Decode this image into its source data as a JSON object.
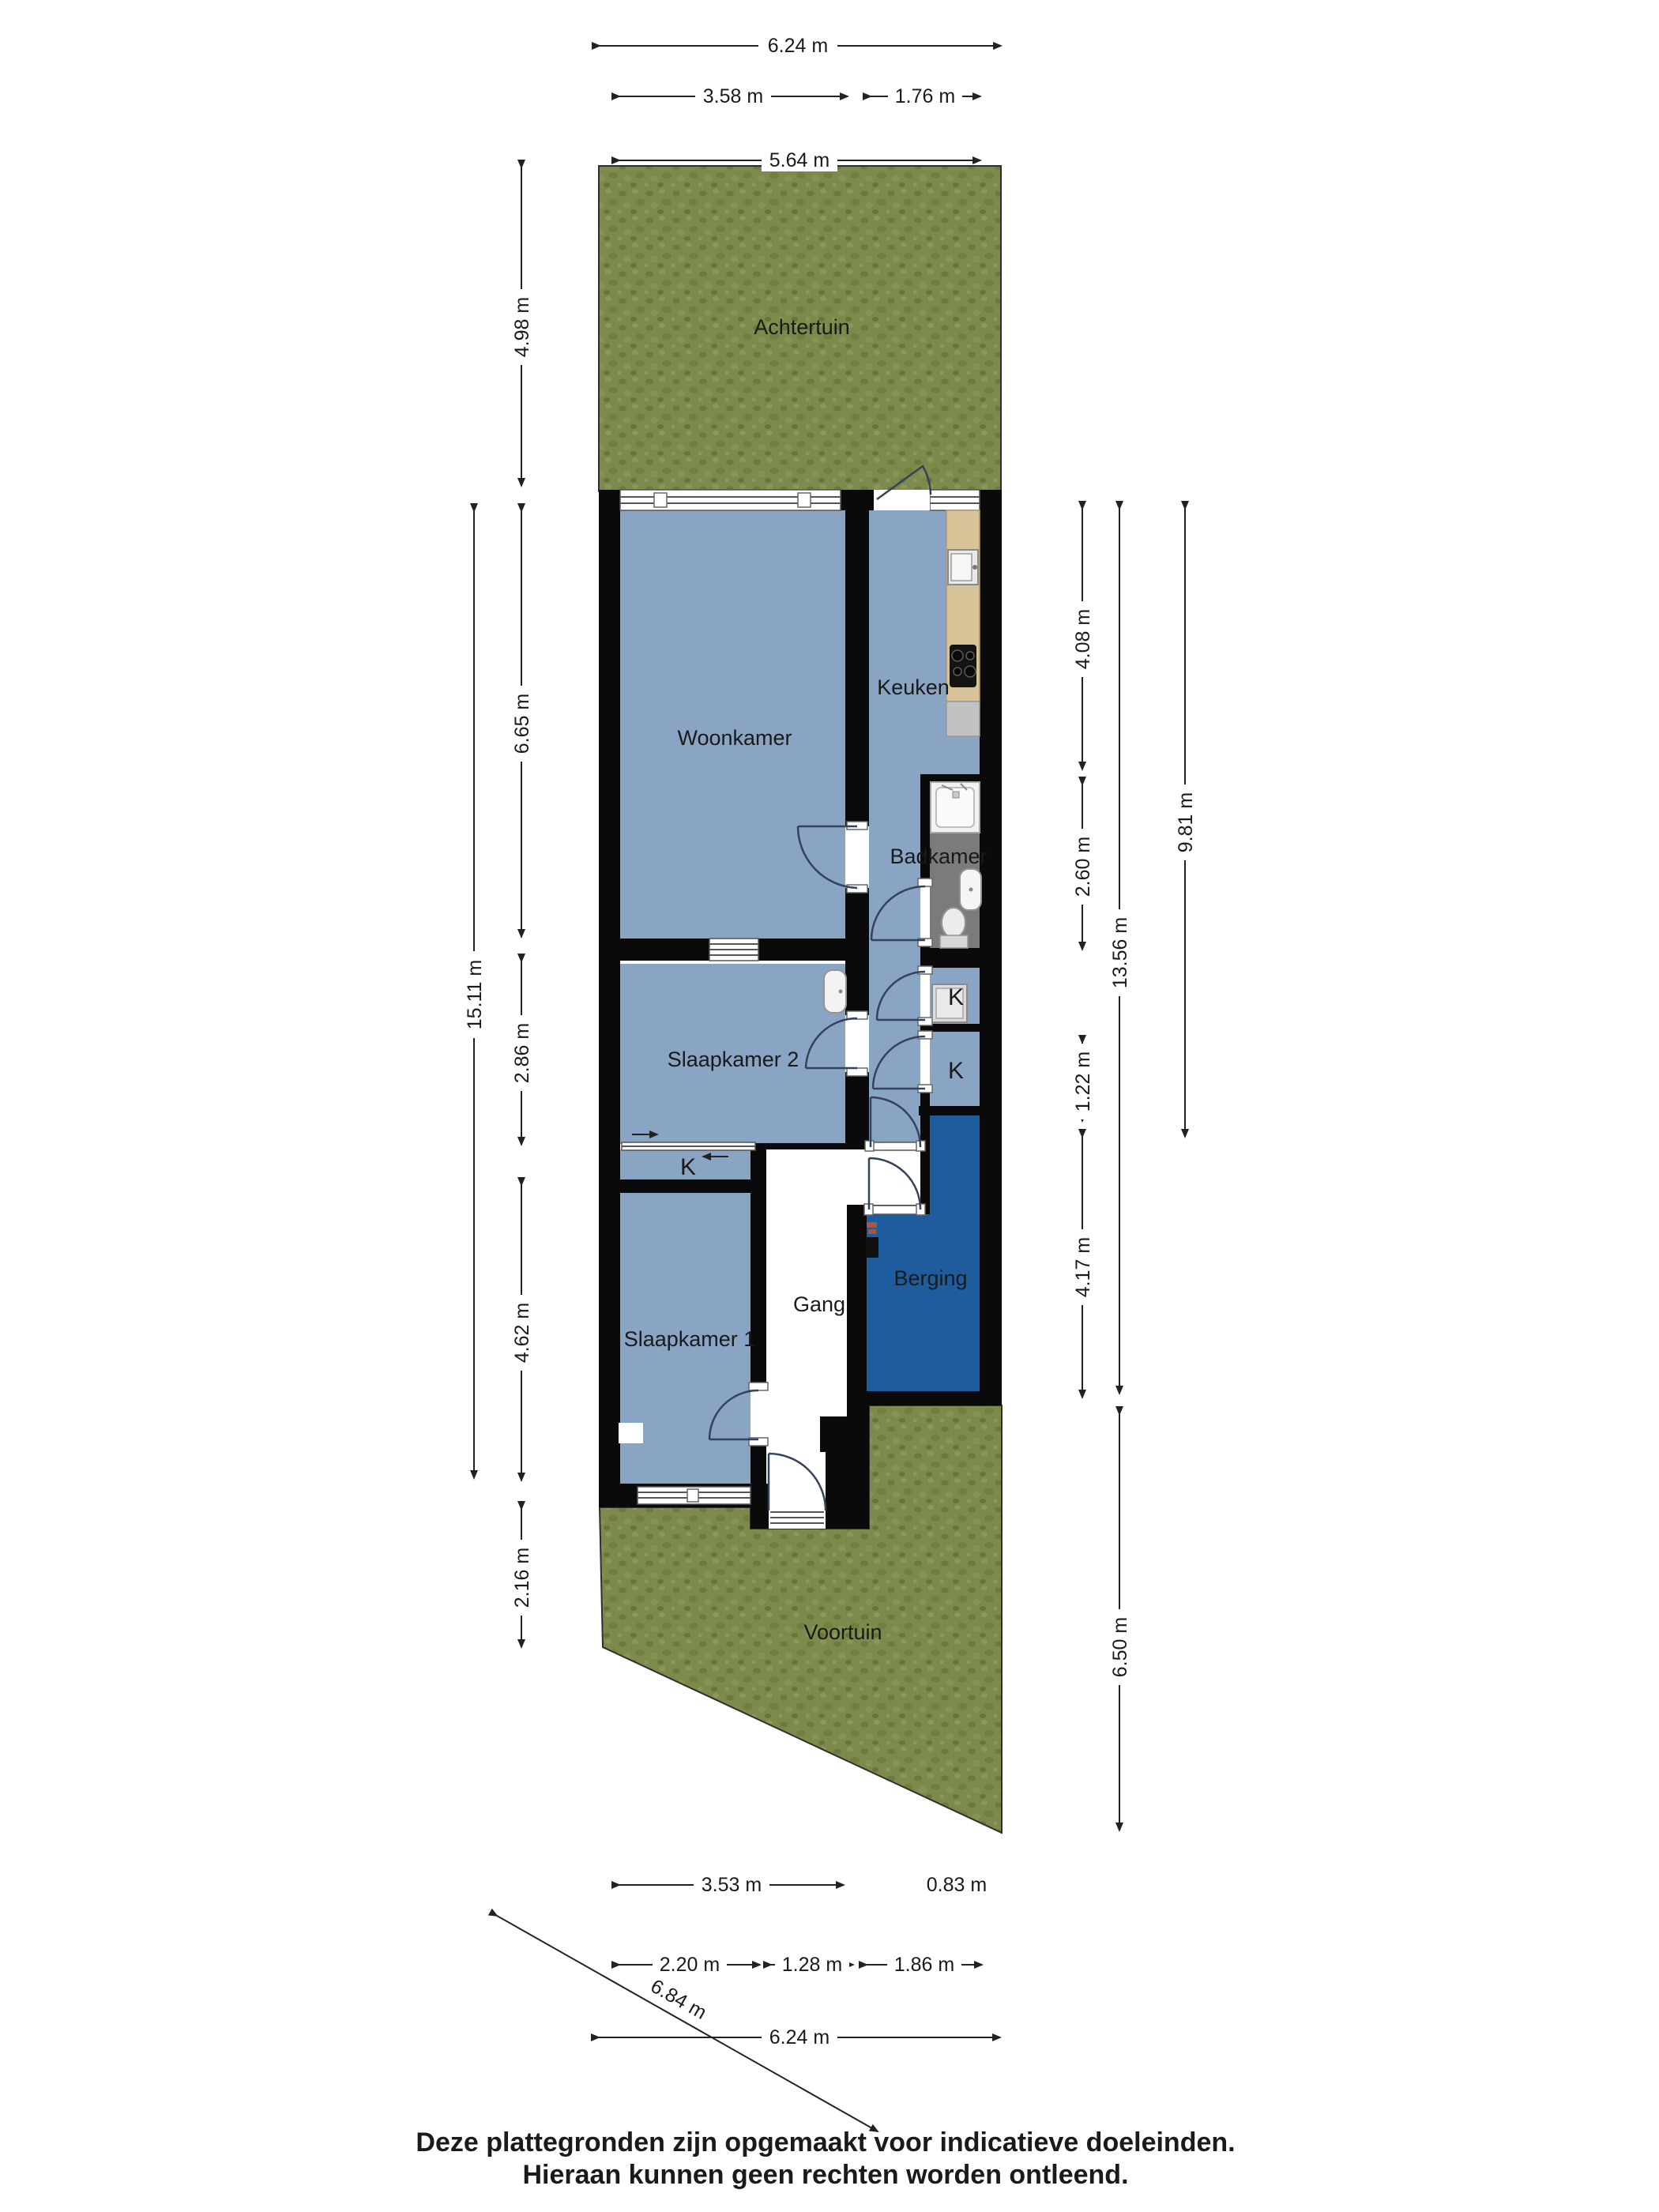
{
  "plan_type": "floor-plan",
  "rooms": {
    "achtertuin": "Achtertuin",
    "woonkamer": "Woonkamer",
    "keuken": "Keuken",
    "badkamer": "Badkamer",
    "slaapkamer2": "Slaapkamer 2",
    "slaapkamer1": "Slaapkamer 1",
    "gang": "Gang",
    "berging": "Berging",
    "voortuin": "Voortuin",
    "kast1": "K",
    "kast2": "K",
    "kast3": "K"
  },
  "dims": {
    "top": [
      {
        "label": "6.24 m"
      },
      {
        "label": "3.58 m"
      },
      {
        "label": "1.76 m"
      },
      {
        "label": "5.64 m"
      }
    ],
    "left": [
      {
        "label": "4.98 m"
      },
      {
        "label": "15.11 m"
      },
      {
        "label": "6.65 m"
      },
      {
        "label": "2.86 m"
      },
      {
        "label": "4.62 m"
      },
      {
        "label": "2.16 m"
      }
    ],
    "right": [
      {
        "label": "4.08 m"
      },
      {
        "label": "2.60 m"
      },
      {
        "label": "1.22 m"
      },
      {
        "label": "4.17 m"
      },
      {
        "label": "13.56 m"
      },
      {
        "label": "9.81 m"
      },
      {
        "label": "6.50 m"
      }
    ],
    "bottom": [
      {
        "label": "3.53 m"
      },
      {
        "label": "0.83 m"
      },
      {
        "label": "2.20 m"
      },
      {
        "label": "1.28 m"
      },
      {
        "label": "1.86 m"
      },
      {
        "label": "6.24 m"
      },
      {
        "label": "6.84 m"
      }
    ]
  },
  "footer": {
    "line1": "Deze plattegronden zijn opgemaakt voor indicatieve doeleinden.",
    "line2": "Hieraan kunnen geen rechten worden ontleend."
  },
  "colors": {
    "room_blue": "#8AA4C3",
    "storage_blue": "#1F5C9E",
    "bathroom_gray": "#7B7B7B",
    "counter_tan": "#D8C298",
    "garden_green": "#7C8B4C",
    "wall_black": "#0A0A0A",
    "background": "#FFFFFF"
  }
}
